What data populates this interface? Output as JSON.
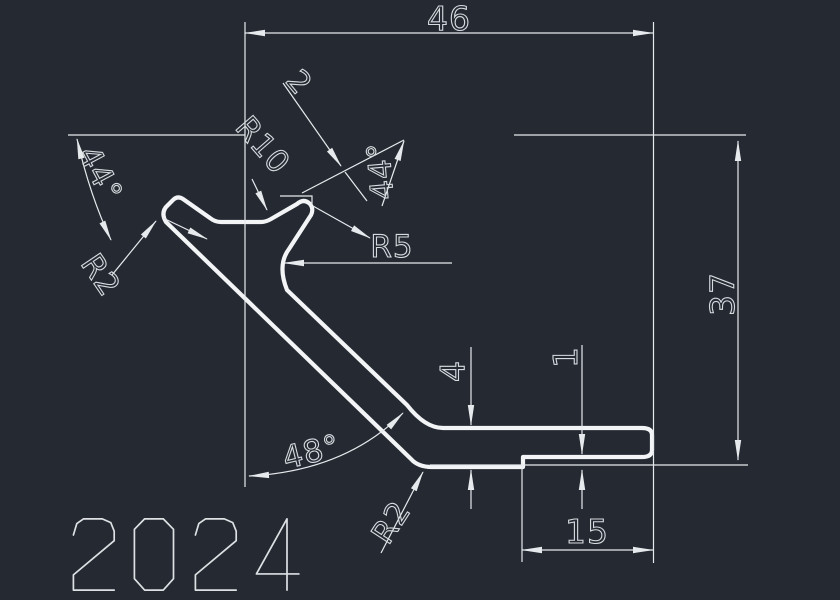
{
  "drawing": {
    "part_number": "2024",
    "dimensions": {
      "overall_width": "46",
      "overall_height": "37",
      "flange_length": "15",
      "wall_thickness": "4",
      "lip_offset": "1",
      "tab_thickness": "2"
    },
    "radii": {
      "groove": "R10",
      "inner_fillet": "R5",
      "tip_fillet": "R2",
      "heel_fillet": "R2"
    },
    "angles": {
      "left": "44°",
      "right": "44°",
      "incline": "48°"
    },
    "colors": {
      "background": "#252932",
      "profile_line": "#f2f4f6",
      "dimension_line": "#e7eaed",
      "dimension_text": "#d6dbdf"
    }
  }
}
